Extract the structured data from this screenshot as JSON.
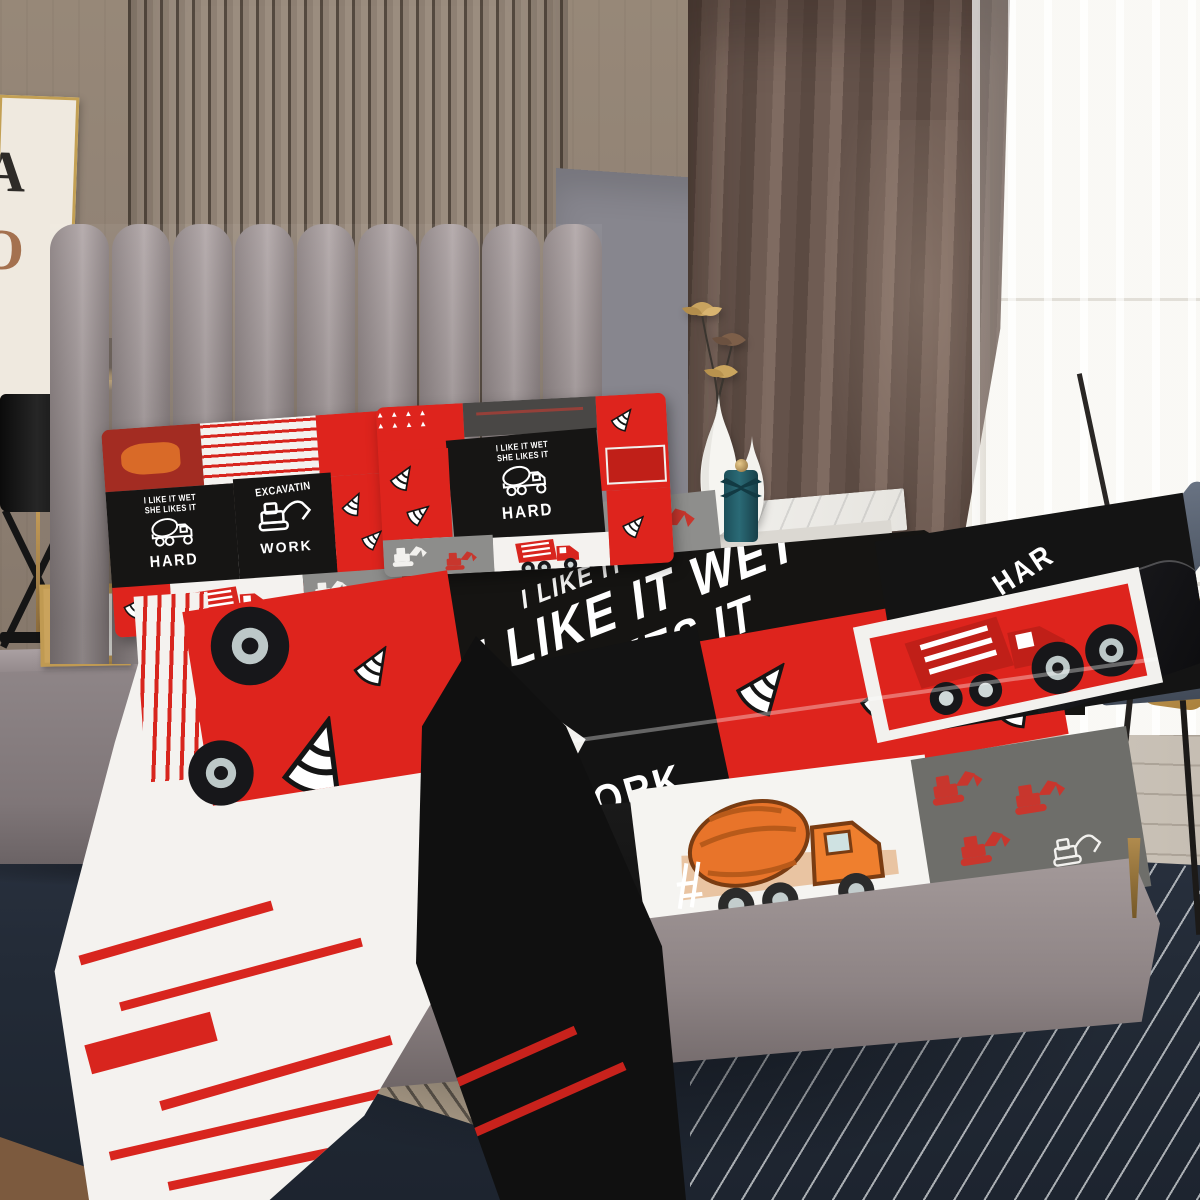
{
  "meta": {
    "scene": "Bedroom product photograph of a construction-truck themed red, black, white and gray patchwork bed sheet set with matching pillowcases",
    "interactive": false
  },
  "colors": {
    "red": "#DE241D",
    "black": "#141414",
    "white": "#F4F2EF",
    "patch_gray": "#8D8D8B",
    "rug_navy": "#242B36",
    "headboard_gray": "#A59C9D",
    "wood_wall": "#8D7F73",
    "curtain_brown": "#6A564E",
    "teal_bottle": "#27606B",
    "mustard_pillow": "#C79B4D",
    "brass": "#A8854B",
    "chair_slate": "#5A6372",
    "frame_gold": "#C09A52"
  },
  "poster": {
    "letter_a": "A",
    "letter_o": "O"
  },
  "photo_frame": {
    "line1": "Photo",
    "line2": "Frame"
  },
  "slogans": {
    "line1": "I LIKE IT WET",
    "line2": "SHE LIKES IT",
    "line1_partial": "I LIKE IT",
    "hard": "HARD",
    "hard_partial": "HAR",
    "excavatin": "EXCAVATIN",
    "work": "WORK",
    "in_partial": "IN"
  },
  "pattern": {
    "triangle_row": "▲ ▲ ▲ ▲"
  },
  "icons": [
    "cement-mixer-truck-icon",
    "dump-truck-icon",
    "excavator-icon",
    "traffic-cone-icon",
    "truck-wheel-icon",
    "lotus-flower-icon"
  ]
}
